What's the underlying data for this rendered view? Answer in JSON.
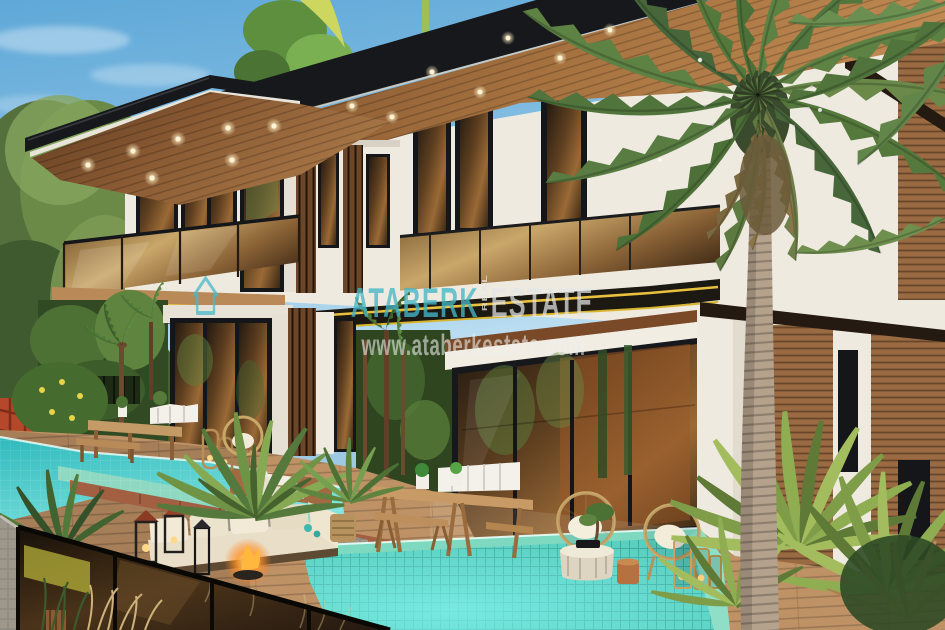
{
  "watermark": {
    "brand": "ATABERK",
    "brand_vertical": "REAL",
    "brand_secondary": "ESTATE",
    "website": "www.ataberkestate.com",
    "brand_color": "#45b6c8",
    "secondary_color": "#e3e6e6",
    "website_color": "#eef0ef",
    "house_icon_color": "#49b8c8"
  },
  "palette": {
    "sky_top": "#5fa8d8",
    "sky_horizon": "#c6e4f3",
    "roof_fascia": "#16181b",
    "soffit_wood": "#8a5a33",
    "wall_white": "#efeae0",
    "glass_bronze": "#7a5228",
    "gold_trim": "#e9c13f",
    "canopy_wood": "#b98a58",
    "deck_wood": "#bf9266",
    "coping_brick": "#a35f42",
    "tile_green": "#8fd9c2",
    "pool_upper": "#3ec6c2",
    "pool_lower": "#4fd0c6",
    "palm_green": "#5d8244",
    "palm_trunk": "#b5a28c",
    "foliage_dark": "#324a24",
    "stone_gray": "#9d978c",
    "sofa_cream": "#e9dfc9",
    "fire_orange": "#ff9a2e"
  }
}
